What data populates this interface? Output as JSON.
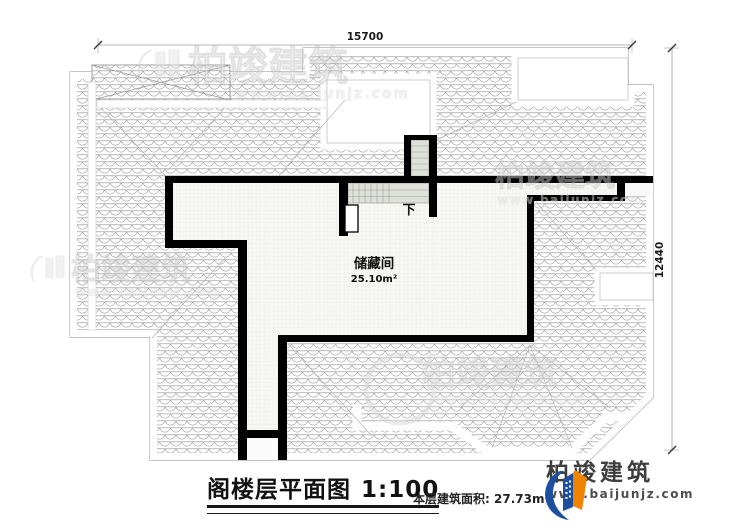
{
  "plan": {
    "room": {
      "name": "储藏间",
      "area": "25.10m²"
    },
    "stair_down_label": "下",
    "dim_top": "15700",
    "dim_right": "12440"
  },
  "footer": {
    "title": "阁楼层平面图",
    "scale": "1:100",
    "area_label": "本层建筑面积:",
    "area_value": "27.73m²"
  },
  "brand": {
    "name": "柏竣建筑",
    "website": "www.baijunjz.com"
  },
  "watermark": {
    "text": "柏竣建筑",
    "url": "www.baijunjz.com"
  },
  "colors": {
    "wall": "#000000",
    "brand_blue": "#1d4f9e",
    "brand_orange": "#f08300",
    "stair_fill": "#dde1d9"
  }
}
